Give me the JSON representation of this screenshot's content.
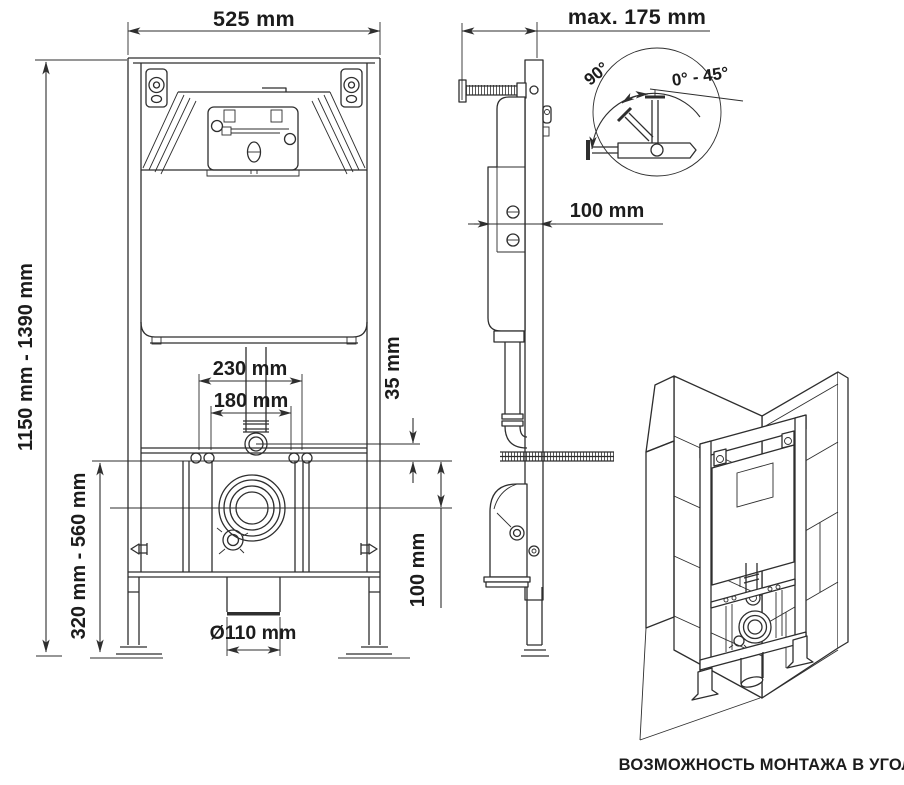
{
  "colors": {
    "line": "#2e2e2e",
    "text": "#1c1c1c",
    "background": "#ffffff"
  },
  "front_view": {
    "dim_width": "525 mm",
    "dim_height_range": "1150 mm - 1390 mm",
    "dim_rail_height_range": "320 mm - 560 mm",
    "dim_fixing_outer": "230 mm",
    "dim_fixing_inner": "180 mm",
    "dim_flush_offset": "35 mm",
    "dim_drain_offset": "100 mm",
    "dim_outlet_diameter": "Ø110 mm"
  },
  "side_view": {
    "dim_max_wall_distance": "max. 175 mm",
    "dim_depth": "100 mm",
    "detail_angles": {
      "swing": "90°",
      "range": "0° - 45°"
    }
  },
  "isometric_view": {
    "caption": "ВОЗМОЖНОСТЬ МОНТАЖА В УГОЛ"
  }
}
